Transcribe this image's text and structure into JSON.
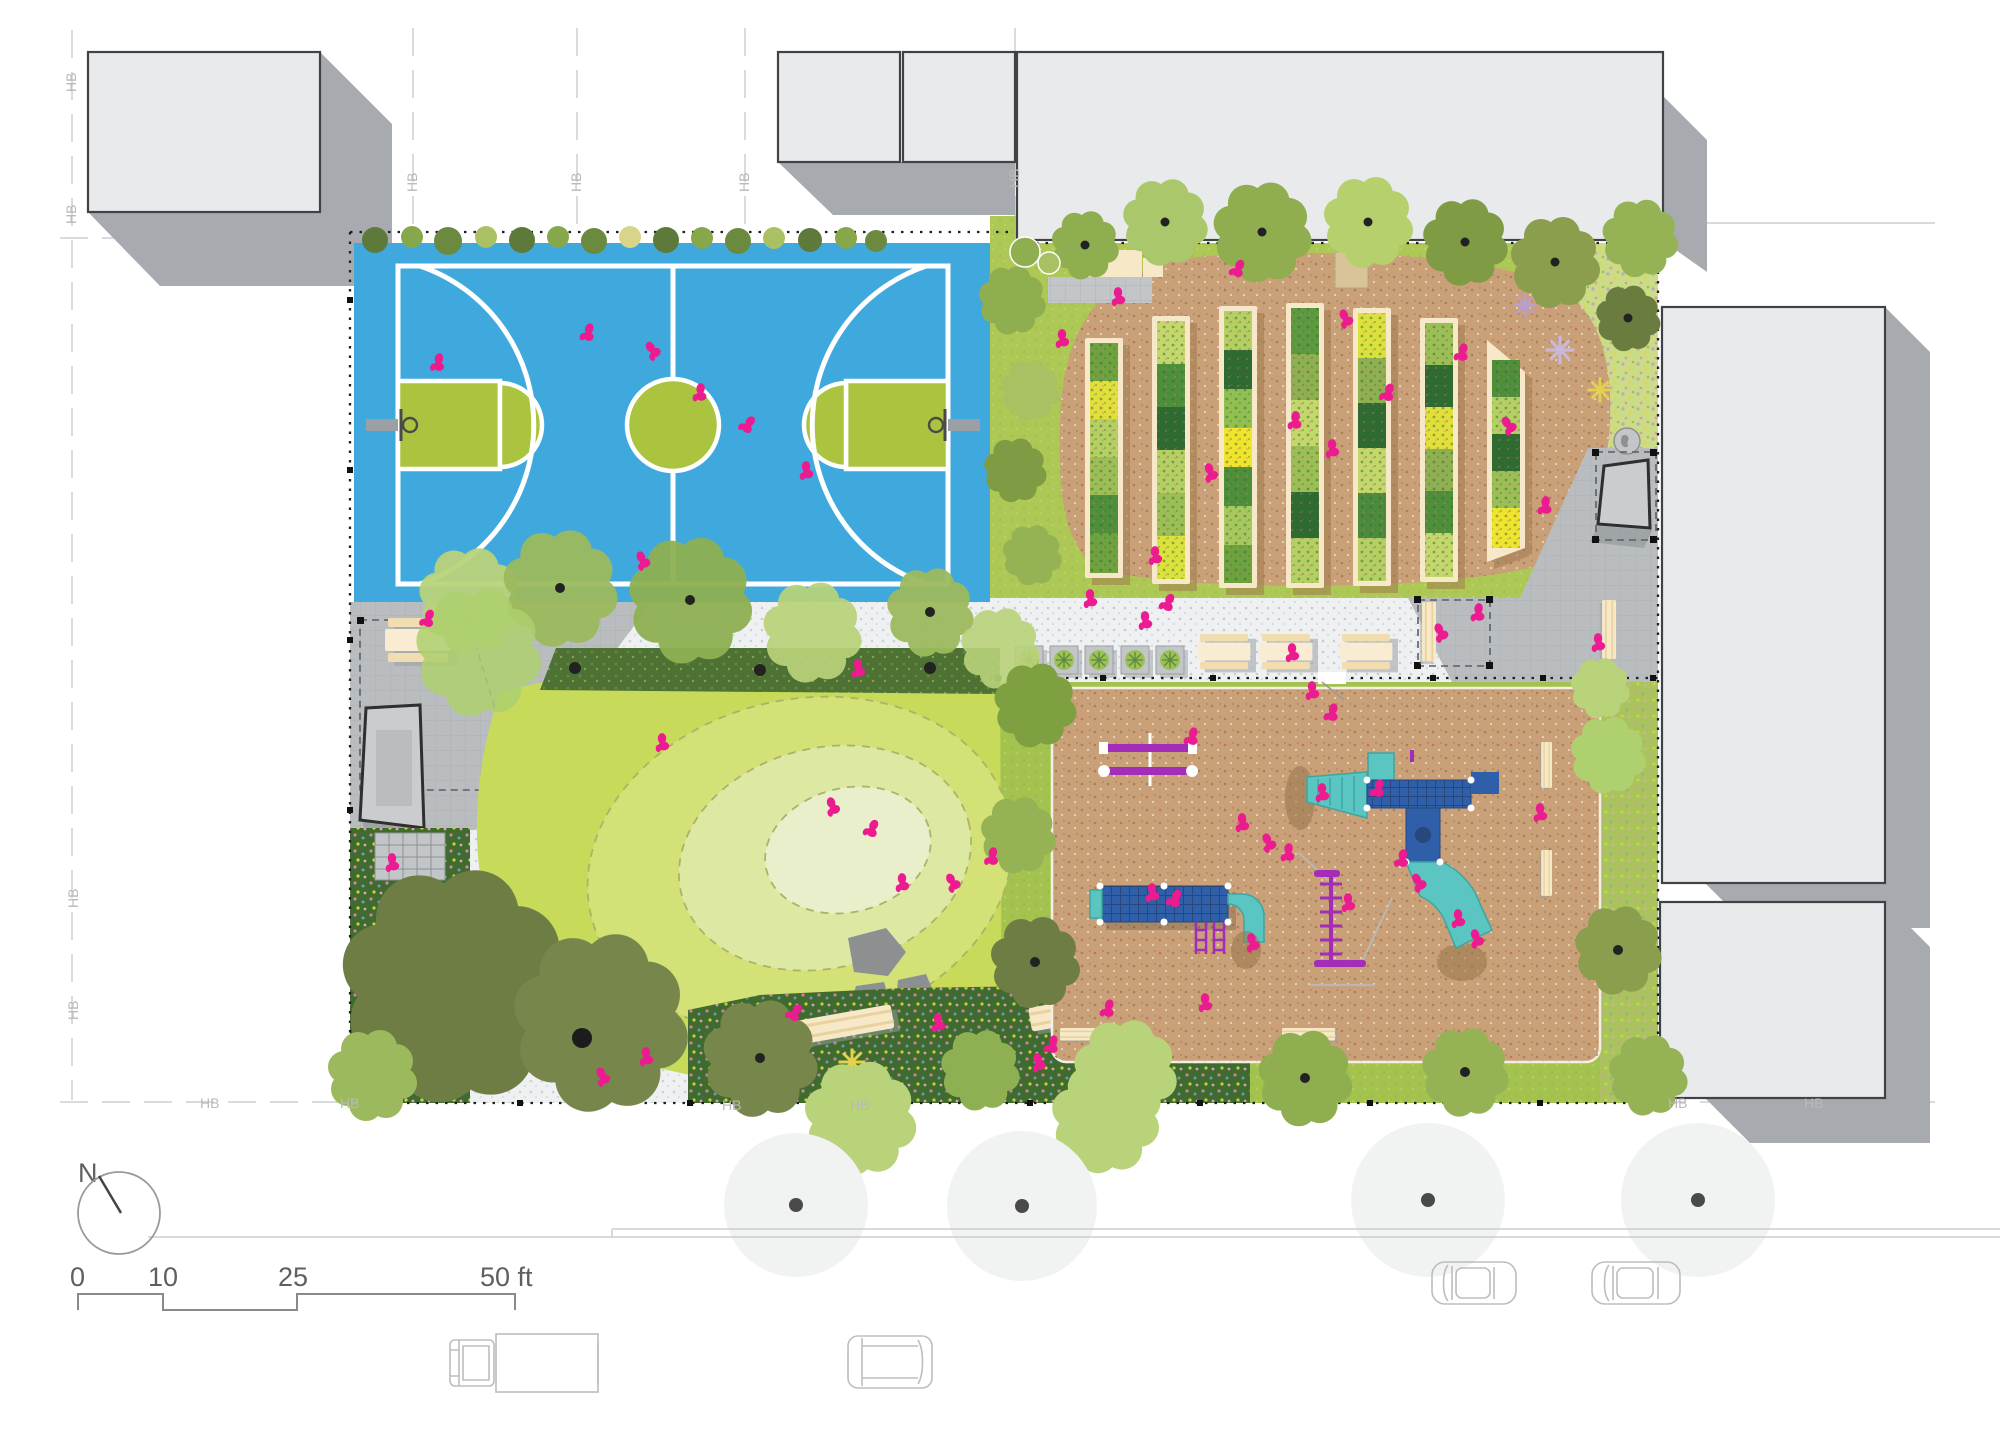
{
  "compass": {
    "label": "N"
  },
  "scale_bar": {
    "labels": {
      "zero": "0",
      "ten": "10",
      "twentyfive": "25",
      "fifty": "50 ft"
    },
    "unit": "ft"
  },
  "labels": {
    "property_line": "HB"
  },
  "colors": {
    "court_blue": "#3fa9dd",
    "court_green": "#abc440",
    "lawn": "#c8da5a",
    "garden_green": "#aec855",
    "sand_tan": "#c9a077",
    "plaza_gray": "#b9bdc0",
    "path_gray": "#eef0f1",
    "building_fill": "#e9eaeb",
    "building_stroke": "#3f4345",
    "building_shadow": "#a7abaf",
    "people_pink": "#ec1b90",
    "play_purple": "#a32cb8",
    "play_blue": "#2f5fa8",
    "play_teal": "#5ac5c1",
    "bench_cream": "#f7e9c8",
    "flower_bed_green": "#3e6b2e",
    "tree_olive": "#6e7d44",
    "tree_medium": "#8fae4f",
    "tree_light": "#b9d37a",
    "street_tree_fill": "#f1f2f2"
  },
  "features": {
    "garden_beds": 7,
    "path_planters": 5,
    "street_tree_canopies": 4,
    "basketball_courts": 1,
    "picnic_tables": 4,
    "vehicles": {
      "cars": 2,
      "box_trucks": 1,
      "vans": 1
    }
  }
}
